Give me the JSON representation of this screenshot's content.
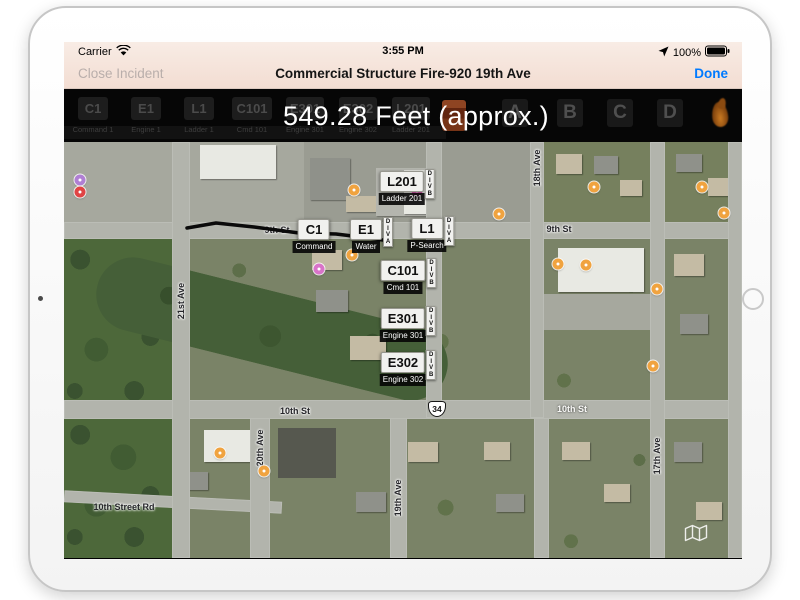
{
  "status_bar": {
    "carrier": "Carrier",
    "time": "3:55 PM",
    "battery_percent": "100%"
  },
  "nav_bar": {
    "close_label": "Close Incident",
    "title": "Commercial Structure Fire-920 19th Ave",
    "done_label": "Done",
    "accent_color": "#007aff",
    "disabled_color": "#b9aeab"
  },
  "toolbar": {
    "measurement_label": "549.28 Feet (approx.)",
    "units": [
      {
        "id": "C1",
        "name": "Command 1"
      },
      {
        "id": "E1",
        "name": "Engine 1"
      },
      {
        "id": "L1",
        "name": "Ladder 1"
      },
      {
        "id": "C101",
        "name": "Cmd 101"
      },
      {
        "id": "E301",
        "name": "Engine 301"
      },
      {
        "id": "E302",
        "name": "Engine 302"
      },
      {
        "id": "L201",
        "name": "Ladder 201"
      }
    ],
    "side_buttons": [
      "A",
      "B",
      "C",
      "D"
    ]
  },
  "map": {
    "markers": [
      {
        "id": "L201",
        "label": "Ladder 201",
        "division": "DIVB",
        "cx": 338,
        "top": 29
      },
      {
        "id": "C1",
        "label": "Command",
        "division": "",
        "cx": 250,
        "top": 77
      },
      {
        "id": "E1",
        "label": "Water",
        "division": "DIVA",
        "cx": 302,
        "top": 77
      },
      {
        "id": "L1",
        "label": "P-Search",
        "division": "DIVA",
        "cx": 363,
        "top": 76
      },
      {
        "id": "C101",
        "label": "Cmd 101",
        "division": "DIVB",
        "cx": 339,
        "top": 118
      },
      {
        "id": "E301",
        "label": "Engine 301",
        "division": "DIVB",
        "cx": 339,
        "top": 166
      },
      {
        "id": "E302",
        "label": "Engine 302",
        "division": "DIVB",
        "cx": 339,
        "top": 210
      }
    ],
    "street_labels": [
      {
        "text": "9th St",
        "x": 213,
        "y": 88,
        "orient": "h",
        "tone": "dark"
      },
      {
        "text": "9th St",
        "x": 495,
        "y": 87,
        "orient": "h",
        "tone": "dark"
      },
      {
        "text": "10th St",
        "x": 231,
        "y": 269,
        "orient": "h",
        "tone": "dark"
      },
      {
        "text": "10th St",
        "x": 508,
        "y": 267,
        "orient": "h",
        "tone": "light"
      },
      {
        "text": "10th Street Rd",
        "x": 60,
        "y": 365,
        "orient": "h",
        "tone": "dark"
      },
      {
        "text": "21st Ave",
        "x": 117,
        "y": 159,
        "orient": "v",
        "tone": "dark"
      },
      {
        "text": "20th Ave",
        "x": 196,
        "y": 306,
        "orient": "v",
        "tone": "dark"
      },
      {
        "text": "19th Ave",
        "x": 334,
        "y": 356,
        "orient": "v",
        "tone": "dark"
      },
      {
        "text": "18th Ave",
        "x": 473,
        "y": 26,
        "orient": "v",
        "tone": "dark"
      },
      {
        "text": "17th Ave",
        "x": 593,
        "y": 314,
        "orient": "v",
        "tone": "dark"
      }
    ],
    "route_shield": {
      "text": "34",
      "x": 373,
      "y": 267
    },
    "measurement_line": [
      [
        123,
        86
      ],
      [
        152,
        81
      ],
      [
        190,
        85
      ],
      [
        235,
        91
      ],
      [
        272,
        92
      ],
      [
        305,
        96
      ],
      [
        326,
        99
      ]
    ],
    "pois": [
      {
        "x": 290,
        "y": 48,
        "color": "#f0a33f"
      },
      {
        "x": 435,
        "y": 72,
        "color": "#f0a33f"
      },
      {
        "x": 530,
        "y": 45,
        "color": "#f0a33f"
      },
      {
        "x": 638,
        "y": 45,
        "color": "#f0a33f"
      },
      {
        "x": 660,
        "y": 71,
        "color": "#f0a33f"
      },
      {
        "x": 593,
        "y": 147,
        "color": "#f0a33f"
      },
      {
        "x": 589,
        "y": 224,
        "color": "#f0a33f"
      },
      {
        "x": 494,
        "y": 122,
        "color": "#f0a33f"
      },
      {
        "x": 522,
        "y": 123,
        "color": "#f0a33f"
      },
      {
        "x": 288,
        "y": 113,
        "color": "#f0a33f"
      },
      {
        "x": 156,
        "y": 311,
        "color": "#f0a33f"
      },
      {
        "x": 200,
        "y": 329,
        "color": "#f0a33f"
      },
      {
        "x": 353,
        "y": 49,
        "color": "#e060b5"
      },
      {
        "x": 255,
        "y": 127,
        "color": "#d973c9"
      },
      {
        "x": 16,
        "y": 38,
        "color": "#b07fd4"
      },
      {
        "x": 16,
        "y": 50,
        "color": "#e04444"
      }
    ]
  }
}
